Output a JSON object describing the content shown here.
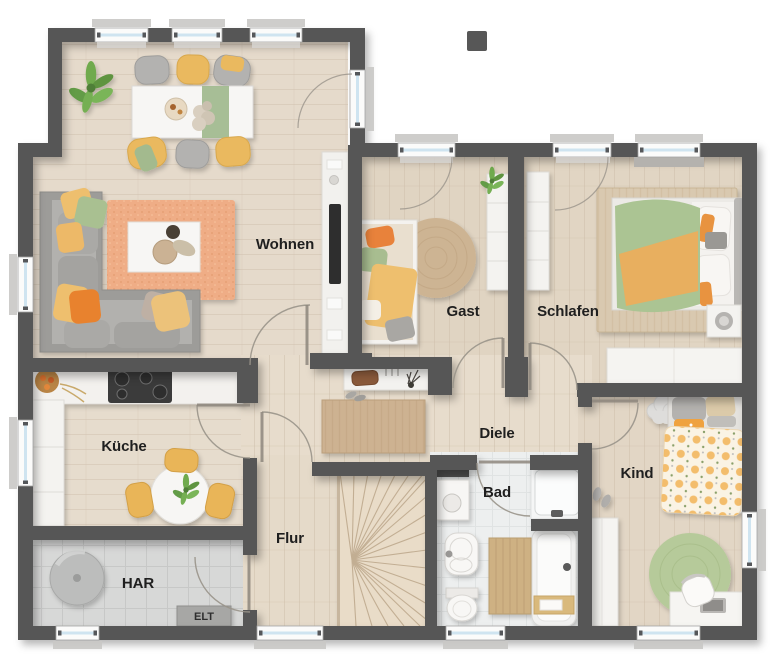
{
  "title": "Grundriss Erdgeschoss Floor Plan",
  "rooms": {
    "wohnen": "Wohnen",
    "gast": "Gast",
    "schlafen": "Schlafen",
    "kueche": "Küche",
    "diele": "Diele",
    "kind": "Kind",
    "flur": "Flur",
    "bad": "Bad",
    "har": "HAR",
    "elt": "ELT"
  },
  "palette": {
    "wall": "#575757",
    "window_glass": "#cfe4f0",
    "floor_wood": "#e4d7c6",
    "floor_wood_dark": "#e0d4c2",
    "floor_tile_gray": "#d7d8d7",
    "floor_bath": "#edefef",
    "accent_orange": "#e8923f",
    "accent_deep_orange": "#e8822e",
    "accent_yellow": "#eebf6e",
    "accent_green": "#a9c091",
    "rug_orange": "#efad86",
    "jute": "#cdb493",
    "furniture_white": "#f6f5f3"
  }
}
